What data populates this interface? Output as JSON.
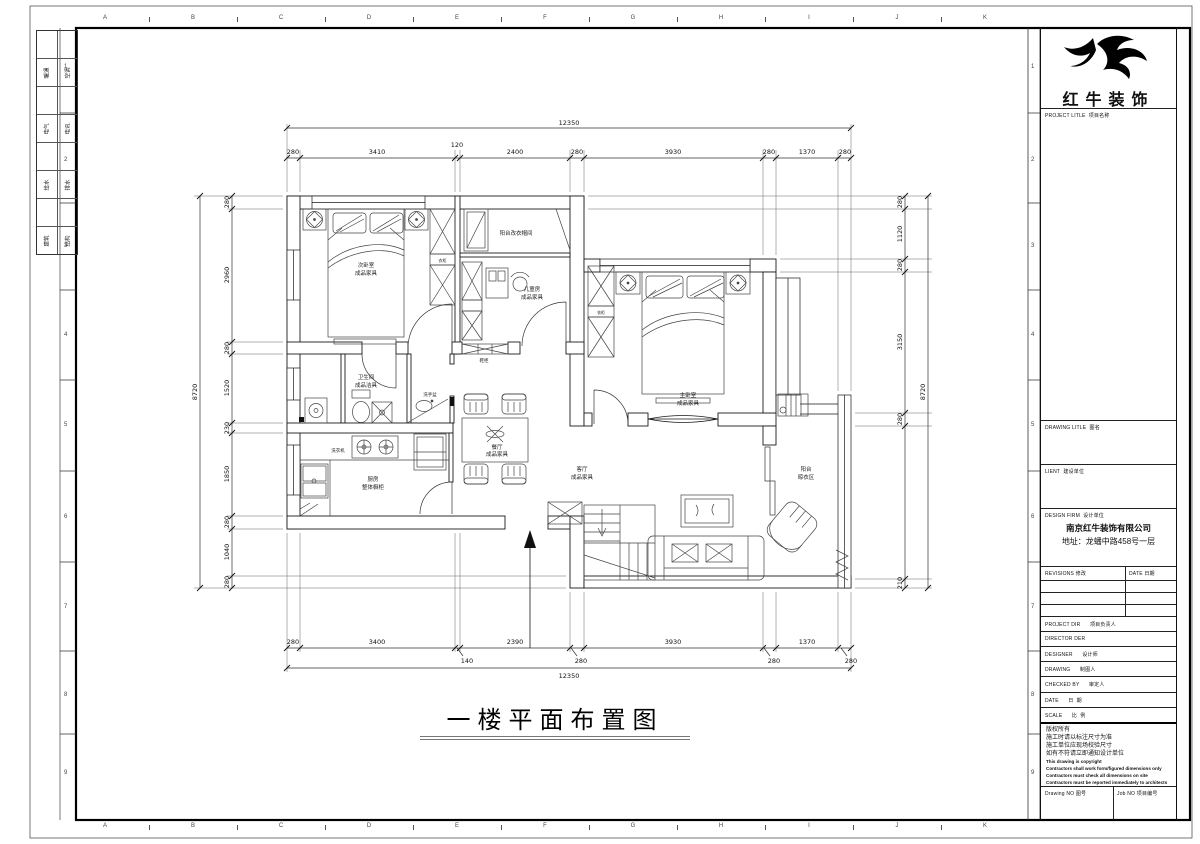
{
  "sheet": {
    "margin_letters": [
      "A",
      "B",
      "C",
      "D",
      "E",
      "F",
      "G",
      "H",
      "I",
      "J",
      "K"
    ],
    "margin_numbers": [
      "1",
      "2",
      "3",
      "4",
      "5",
      "6",
      "7",
      "8",
      "9"
    ],
    "sig_table": [
      [
        "暖通",
        "空调"
      ],
      [
        "电气",
        "电讯"
      ],
      [
        "给水",
        "排水"
      ],
      [
        "建筑",
        "结构"
      ]
    ]
  },
  "title": {
    "text": "一楼平面布置图"
  },
  "plan": {
    "dims": {
      "top": {
        "total": "12350",
        "segments": [
          "280",
          "3410",
          "120",
          "2400",
          "280",
          "3930",
          "280",
          "1370",
          "280"
        ]
      },
      "bottom": {
        "total": "12350",
        "segments": [
          "280",
          "3400",
          "140",
          "2390",
          "280",
          "3930",
          "280",
          "1370",
          "280"
        ]
      },
      "left": {
        "total": "8720",
        "segments": [
          "280",
          "2960",
          "280",
          "1520",
          "230",
          "1850",
          "280",
          "1040",
          "280"
        ]
      },
      "right": {
        "total": "8720",
        "segments": [
          "280",
          "1120",
          "280",
          "3150",
          "280",
          "210"
        ]
      }
    },
    "rooms": {
      "ciwo": {
        "n": "次卧室",
        "m": "成品家具"
      },
      "yimao": {
        "n": "阳台改衣帽间"
      },
      "ertong": {
        "n": "儿童房",
        "m": "成品家具"
      },
      "zhuwo": {
        "n": "主卧室",
        "m": "成品家具"
      },
      "wsj": {
        "n": "卫生间",
        "m": "成品洁具"
      },
      "guanxi": {
        "n": "洗手盆"
      },
      "chufang": {
        "n": "厨房",
        "m": "整体橱柜"
      },
      "xiyiji": {
        "n": "洗衣机"
      },
      "canting": {
        "n": "餐厅",
        "m": "成品家具"
      },
      "keting": {
        "n": "客厅",
        "m": "成品家具"
      },
      "yangtai": {
        "n": "阳台",
        "m": "晾衣区"
      },
      "xiegui": {
        "n": "鞋柜"
      },
      "yigui1": {
        "n": "衣柜"
      },
      "yigui2": {
        "n": "衣柜"
      }
    }
  },
  "titleblock": {
    "brand": "红牛装饰",
    "project_title_en": "PROJECT LITLE",
    "project_title_cn": "项目名称",
    "drawing_title_en": "DRAWING LITLE",
    "drawing_title_cn": "图名",
    "client_en": "LIENT",
    "client_cn": "建设单位",
    "design_firm_en": "DESIGN FIRM",
    "design_firm_cn": "设计单位",
    "company": "南京红牛装饰有限公司",
    "address": "地址：龙蟠中路458号一层",
    "revisions_en": "REVISIONS",
    "revisions_cn": "修改",
    "date_col_en": "DATE",
    "date_col_cn": "日期",
    "fields": [
      {
        "en": "PROJECT DIR",
        "cn": "项目负责人"
      },
      {
        "en": "DIRECTOR DER",
        "cn": ""
      },
      {
        "en": "DESIGNER",
        "cn": "设计师"
      },
      {
        "en": "DRAWING",
        "cn": "制图人"
      },
      {
        "en": "CHECKED BY",
        "cn": "审定人"
      },
      {
        "en": "DATE",
        "cn": "日  期"
      },
      {
        "en": "SCALE",
        "cn": "比  例"
      }
    ],
    "notes_cn": [
      "版权所有",
      "施工时请以标注尺寸为准",
      "施工单位应现场校验尺寸",
      "如有不符请立即通知设计单位"
    ],
    "notes_en": [
      "This drawing is copyright",
      "Contractors shall work form/figured dimensions only",
      "Contractors must check all dimensions on site",
      "Contractors must be reported immediately to architects"
    ],
    "drawing_no_en": "Drawing NO",
    "drawing_no_cn": "图号",
    "job_no_en": "Job NO",
    "job_no_cn": "项目编号"
  }
}
